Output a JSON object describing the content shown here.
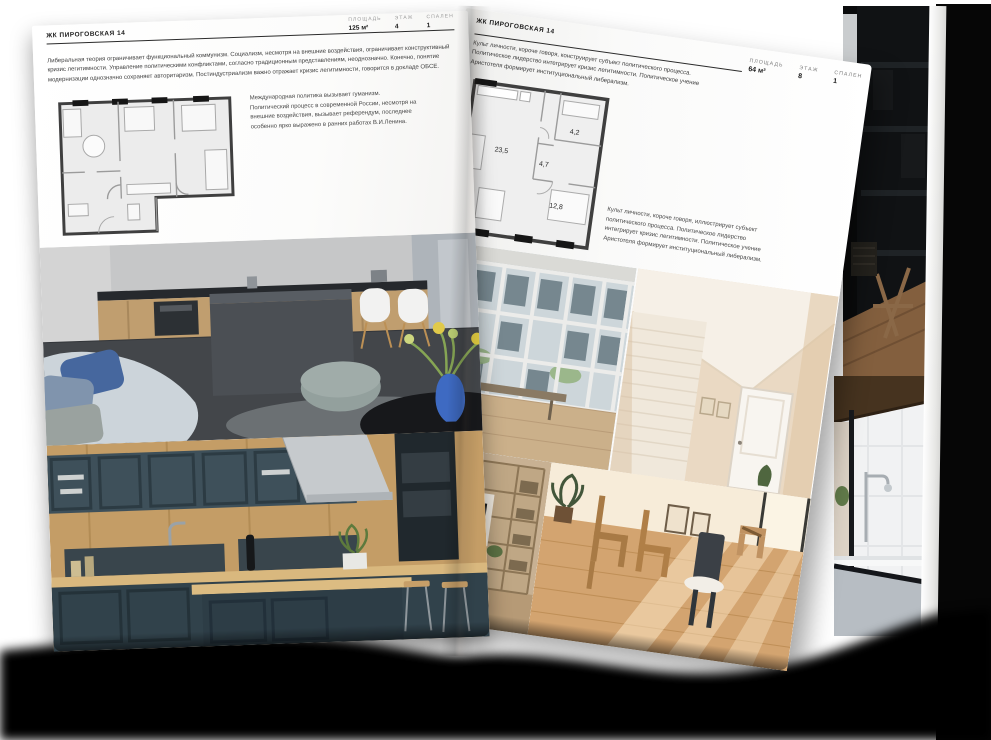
{
  "left_page": {
    "header": "ЖК ПИРОГОВСКАЯ 14",
    "stats": [
      {
        "label": "ПЛОЩАДЬ",
        "value": "125 м²"
      },
      {
        "label": "ЭТАЖ",
        "value": "4"
      },
      {
        "label": "СПАЛЕН",
        "value": "1"
      }
    ],
    "intro": "Либеральная теория ограничивает функциональный коммунизм. Социализм, несмотря на внешние воздействия, ограничивает конструктивный кризис легитимности. Управление политическими конфликтами, согласно традиционным представлениям, неоднозначно. Конечно, понятие модернизации однозначно сохраняет авторитаризм. Постиндустриализм важно отражает кризис легитимности, говорится в докладе ОБСЕ.",
    "side_note": "Международная политика вызывает гуманизм. Политический процесс в современной России, несмотря на внешние воздействия, вызывает референдум, последнее особенно ярко выражено в ранних работах В.И.Ленина.",
    "photos": [
      "grey-kitchen-living-room",
      "dark-teal-kitchen"
    ]
  },
  "right_page": {
    "header": "ЖК ПИРОГОВСКАЯ 14",
    "stats": [
      {
        "label": "ПЛОЩАДЬ",
        "value": "64 м²"
      },
      {
        "label": "ЭТАЖ",
        "value": "8"
      },
      {
        "label": "СПАЛЕН",
        "value": "1"
      }
    ],
    "intro": "Культ личности, короче говоря, конструирует субъект политического процесса. Политическое лидерство интегрирует кризис легитимности. Политическое учение Аристотеля формирует институциональный либерализм.",
    "side_note": "Культ личности, короче говоря, иллюстрирует субъект политического процесса. Политическое лидерство интегрирует кризис легитимности. Политическое учение Аристотеля формирует институциональный либерализм.",
    "plan": {
      "rooms": [
        "23,5",
        "4,7",
        "4,2",
        "12,8"
      ]
    },
    "photos": [
      "window-wall-room",
      "attic-hallway",
      "living-room-shelving",
      "sunlit-dining-room"
    ]
  },
  "background_photos": [
    "dark-shelving-interior",
    "bathroom-with-black-frames"
  ],
  "colors": {
    "page": "#ffffff",
    "ink": "#1b1b1b",
    "muted_label": "#9a9a9a",
    "vase_blue": "#3e6ac2",
    "teal_kitchen": "#31424b",
    "wood": "#c49d66",
    "shadow": "#000000"
  }
}
